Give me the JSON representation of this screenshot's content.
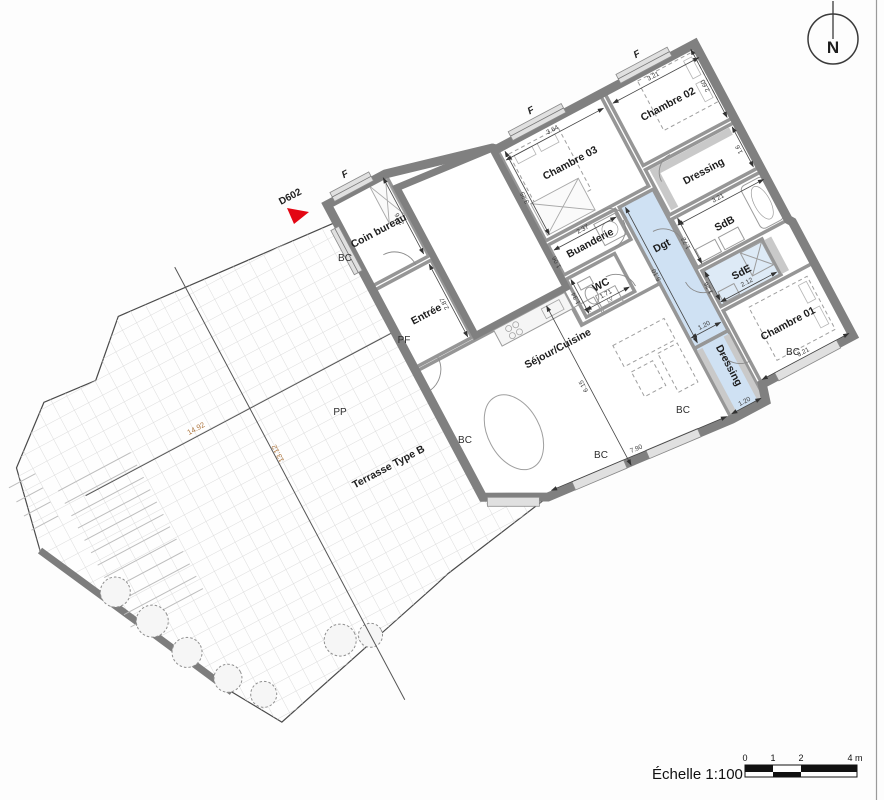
{
  "compass": {
    "label": "N"
  },
  "flat_ref": {
    "label": "D602",
    "color": "#e30613"
  },
  "scale_bar": {
    "label": "Échelle 1:100",
    "ticks": [
      "0",
      "1",
      "2",
      "4 m"
    ]
  },
  "rooms": [
    {
      "id": "chambre-03",
      "label": "Chambre 03",
      "dims": {
        "w": "3.64",
        "h": "3.25"
      }
    },
    {
      "id": "chambre-02",
      "label": "Chambre 02",
      "dims": {
        "w": "3.21",
        "h": "2.60"
      }
    },
    {
      "id": "dressing-haut",
      "label": "Dressing",
      "dims": {
        "h": "1.6"
      }
    },
    {
      "id": "sdb",
      "label": "SdB",
      "dims": {
        "w": "3.21",
        "h": "1.72"
      }
    },
    {
      "id": "buanderie",
      "label": "Buanderie",
      "dims": {
        "w": "2.37",
        "h": "1.06"
      }
    },
    {
      "id": "wc",
      "label": "WC",
      "dims": {
        "w": "1.71",
        "h": "1.34"
      }
    },
    {
      "id": "dgt",
      "label": "Dgt",
      "dims": {
        "w": "1.20",
        "l": "5.10"
      }
    },
    {
      "id": "sde",
      "label": "SdE",
      "dims": {
        "w": "2.12",
        "h": "1.26"
      }
    },
    {
      "id": "chambre-01",
      "label": "Chambre 01",
      "dims": {
        "w": "3.21"
      }
    },
    {
      "id": "dressing-bas",
      "label": "Dressing",
      "dims": {
        "w": "1.20"
      }
    },
    {
      "id": "sejour",
      "label": "Séjour/Cuisine",
      "dims": {
        "w": "7.90",
        "h": "6.15"
      }
    },
    {
      "id": "entree",
      "label": "Entrée",
      "dims": {
        "l": "2.87"
      }
    },
    {
      "id": "coin-bureau",
      "label": "Coin bureau",
      "dims": {
        "l": "2.76"
      }
    }
  ],
  "terrace": {
    "label": "Terrasse Type B",
    "dim_x": "14.92",
    "dim_y": "13.12"
  },
  "openings": {
    "window_label": "F",
    "bay_label": "BC",
    "entry_door_label": "PP",
    "french_door_label": "PF"
  },
  "kitchen": {
    "appliances": [
      "R",
      "LV"
    ]
  },
  "colors": {
    "circulation_fill": "#cfe1f3",
    "highlight_fill": "#ddeaf6",
    "wall": "#808080"
  }
}
